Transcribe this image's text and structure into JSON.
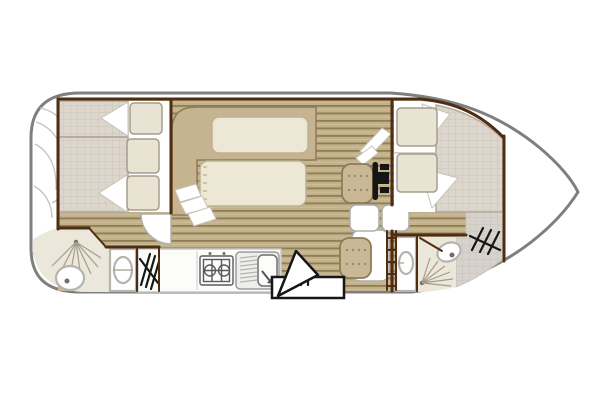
{
  "diagram": {
    "type": "boat floor plan",
    "regions": {
      "stern_deck": {
        "label": "stern deck"
      },
      "aft_cabin": {
        "label": "aft cabin",
        "beds": 2,
        "pillows": 3
      },
      "aft_bathroom": {
        "label": "aft bathroom",
        "fixtures": [
          "shower",
          "toilet",
          "washbasin",
          "steps"
        ]
      },
      "galley": {
        "label": "galley",
        "fixtures": [
          "fridge",
          "stove",
          "sink"
        ],
        "burners": 2
      },
      "salon": {
        "label": "salon dinette",
        "fixtures": [
          "u-bench",
          "table"
        ]
      },
      "helm": {
        "label": "steering position",
        "fixtures": [
          "helm seat",
          "co-pilot seat",
          "steering wheel"
        ]
      },
      "companionway": {
        "label": "folding boarding ladder"
      },
      "bow_cabin": {
        "label": "bow cabin",
        "beds": 2,
        "pillows": 2
      },
      "bow_bathroom": {
        "label": "bow bathroom",
        "fixtures": [
          "washbasin",
          "shower",
          "toilet"
        ]
      },
      "bow_steps": {
        "label": "bow deck steps"
      }
    }
  },
  "colors": {
    "hull_outline": "#7f7f7f",
    "wall_brown": "#4e2d12",
    "floor_tan": "#c2b189",
    "floor_line": "#8e7d55",
    "bed_grid": "#dcd6cc",
    "bed_grid_line": "#ccc5b9",
    "bed_grid_border": "#b2a99c",
    "pillow": "#e9e3d3",
    "pillow_border": "#a59d8d",
    "bedding_white": "#ffffff",
    "bedding_border": "#c9c4b8",
    "bench_tan": "#c6b491",
    "bench_border": "#8d7c58",
    "table_cream": "#ede7d5",
    "table_border": "#bdb295",
    "seat_tan": "#c9b796",
    "seat_stitch": "#9a8a66",
    "bath_floor": "#ece7db",
    "fixture_white": "#ffffff",
    "fixture_border": "#b5b5b0",
    "fixture_dot": "#6e6e6e",
    "spray_line": "#a69c8a",
    "counter_white": "#fcfcfb",
    "counter_border": "#c8c8c8",
    "appliance_line": "#5a5a5a",
    "hatch_black": "#161616",
    "deck_gray": "#d7d3cc",
    "deck_gray_line": "#c7c3bc",
    "deck_arc": "#c2c2c2",
    "door_white": "#ffffff",
    "door_border": "#aeaeae",
    "wheel_black": "#151515"
  }
}
